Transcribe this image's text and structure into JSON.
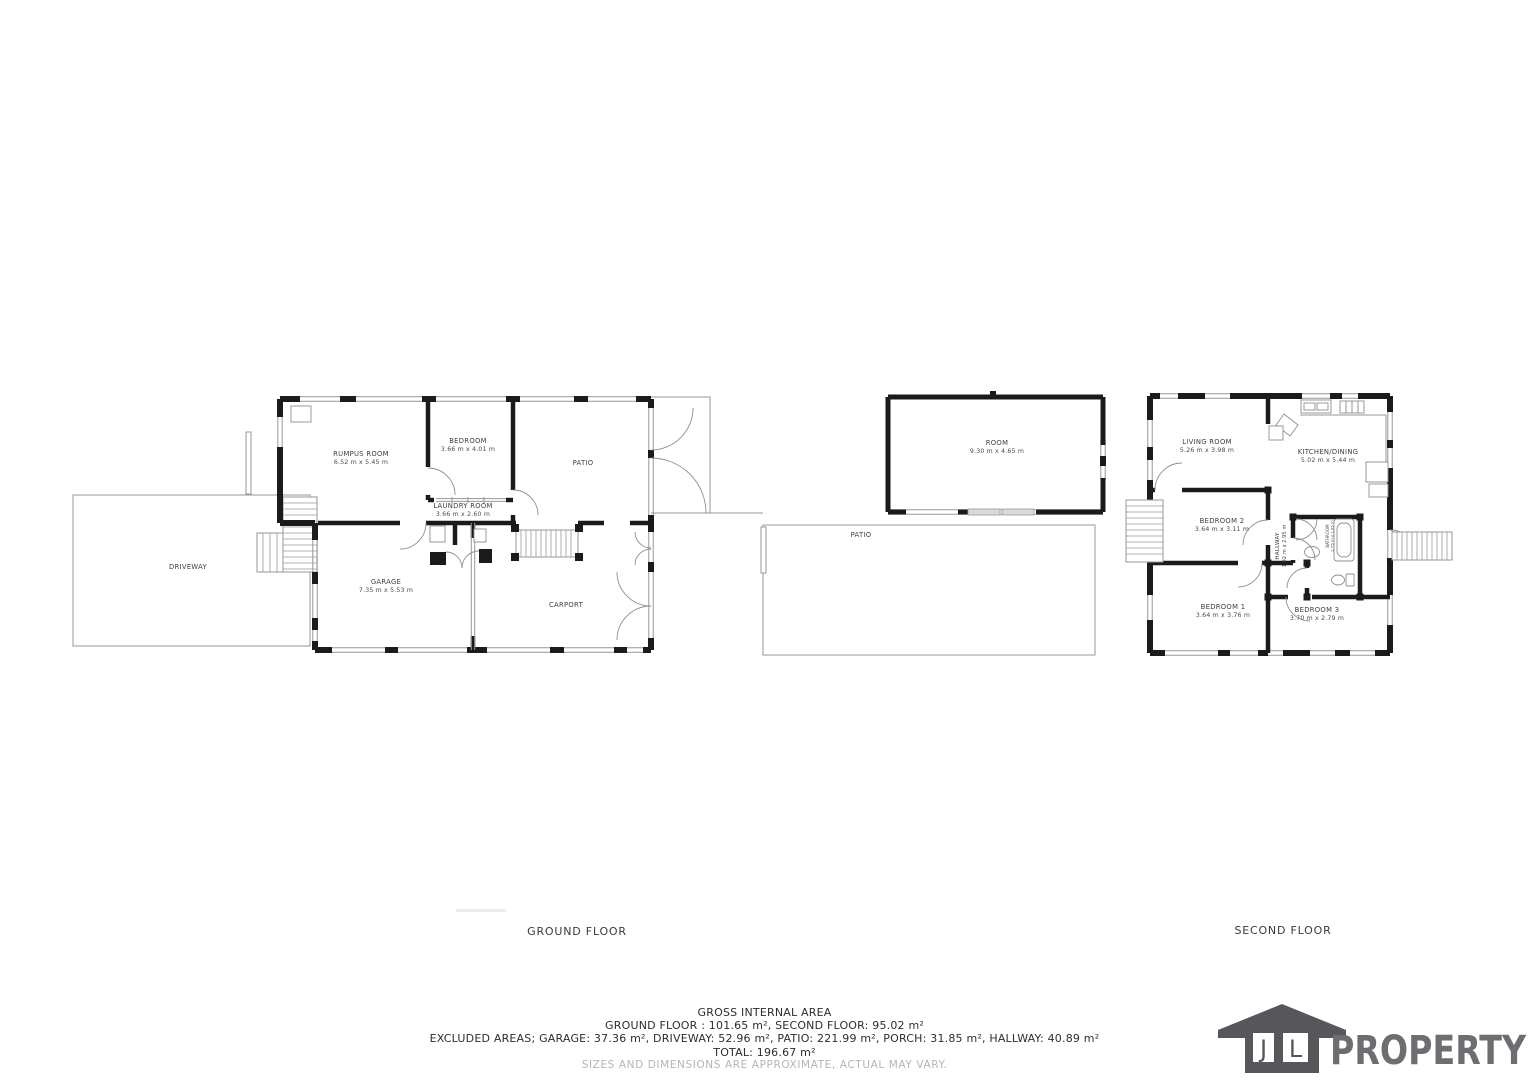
{
  "palette": {
    "wall": "#1b1b1b",
    "thin_line": "#979797",
    "label_text": "#3d3d3d",
    "muted_text": "#b5b5b5",
    "logo_gray": "#56575a",
    "logo_text": "#6d6e71"
  },
  "floors": {
    "ground": {
      "title": "GROUND FLOOR",
      "rooms": {
        "rumpus": {
          "name": "RUMPUS ROOM",
          "dims": "6.52 m x 5.45 m"
        },
        "bedroom": {
          "name": "BEDROOM",
          "dims": "3.66 m x 4.01 m"
        },
        "patio_inner": {
          "name": "PATIO"
        },
        "laundry": {
          "name": "LAUNDRY ROOM",
          "dims": "3.66 m x 2.60 m"
        },
        "garage": {
          "name": "GARAGE",
          "dims": "7.35 m x 5.53 m"
        },
        "carport": {
          "name": "CARPORT"
        },
        "driveway": {
          "name": "DRIVEWAY"
        },
        "room": {
          "name": "ROOM",
          "dims": "9.30 m x 4.65 m"
        },
        "patio_rear": {
          "name": "PATIO"
        }
      }
    },
    "second": {
      "title": "SECOND FLOOR",
      "rooms": {
        "living": {
          "name": "LIVING ROOM",
          "dims": "5.26 m x 3.98 m"
        },
        "kitchen": {
          "name": "KITCHEN/DINING",
          "dims": "5.02 m x 5.44 m"
        },
        "bedroom2": {
          "name": "BEDROOM 2",
          "dims": "3.64 m x 3.11 m"
        },
        "hallway": {
          "name": "HALLWAY",
          "dims": "1.92 m x 2.95 m"
        },
        "bathroom": {
          "name": "BATHROOM",
          "dims": "2.75 m x 1.65 m"
        },
        "bedroom1": {
          "name": "BEDROOM 1",
          "dims": "3.64 m x 3.76 m"
        },
        "bedroom3": {
          "name": "BEDROOM 3",
          "dims": "3.70 m x 2.79 m"
        }
      }
    }
  },
  "summary": {
    "title": "GROSS INTERNAL AREA",
    "floors_line": "GROUND FLOOR : 101.65 m², SECOND FLOOR: 95.02 m²",
    "excluded_line": "EXCLUDED AREAS; GARAGE: 37.36 m², DRIVEWAY: 52.96 m², PATIO: 221.99 m², PORCH: 31.85 m², HALLWAY: 40.89 m²",
    "total_line": "TOTAL: 196.67 m²",
    "disclaimer": "SIZES AND DIMENSIONS ARE APPROXIMATE, ACTUAL MAY VARY."
  },
  "logo": {
    "initial_left": "J",
    "initial_right": "L",
    "brand": "PROPERTY"
  }
}
